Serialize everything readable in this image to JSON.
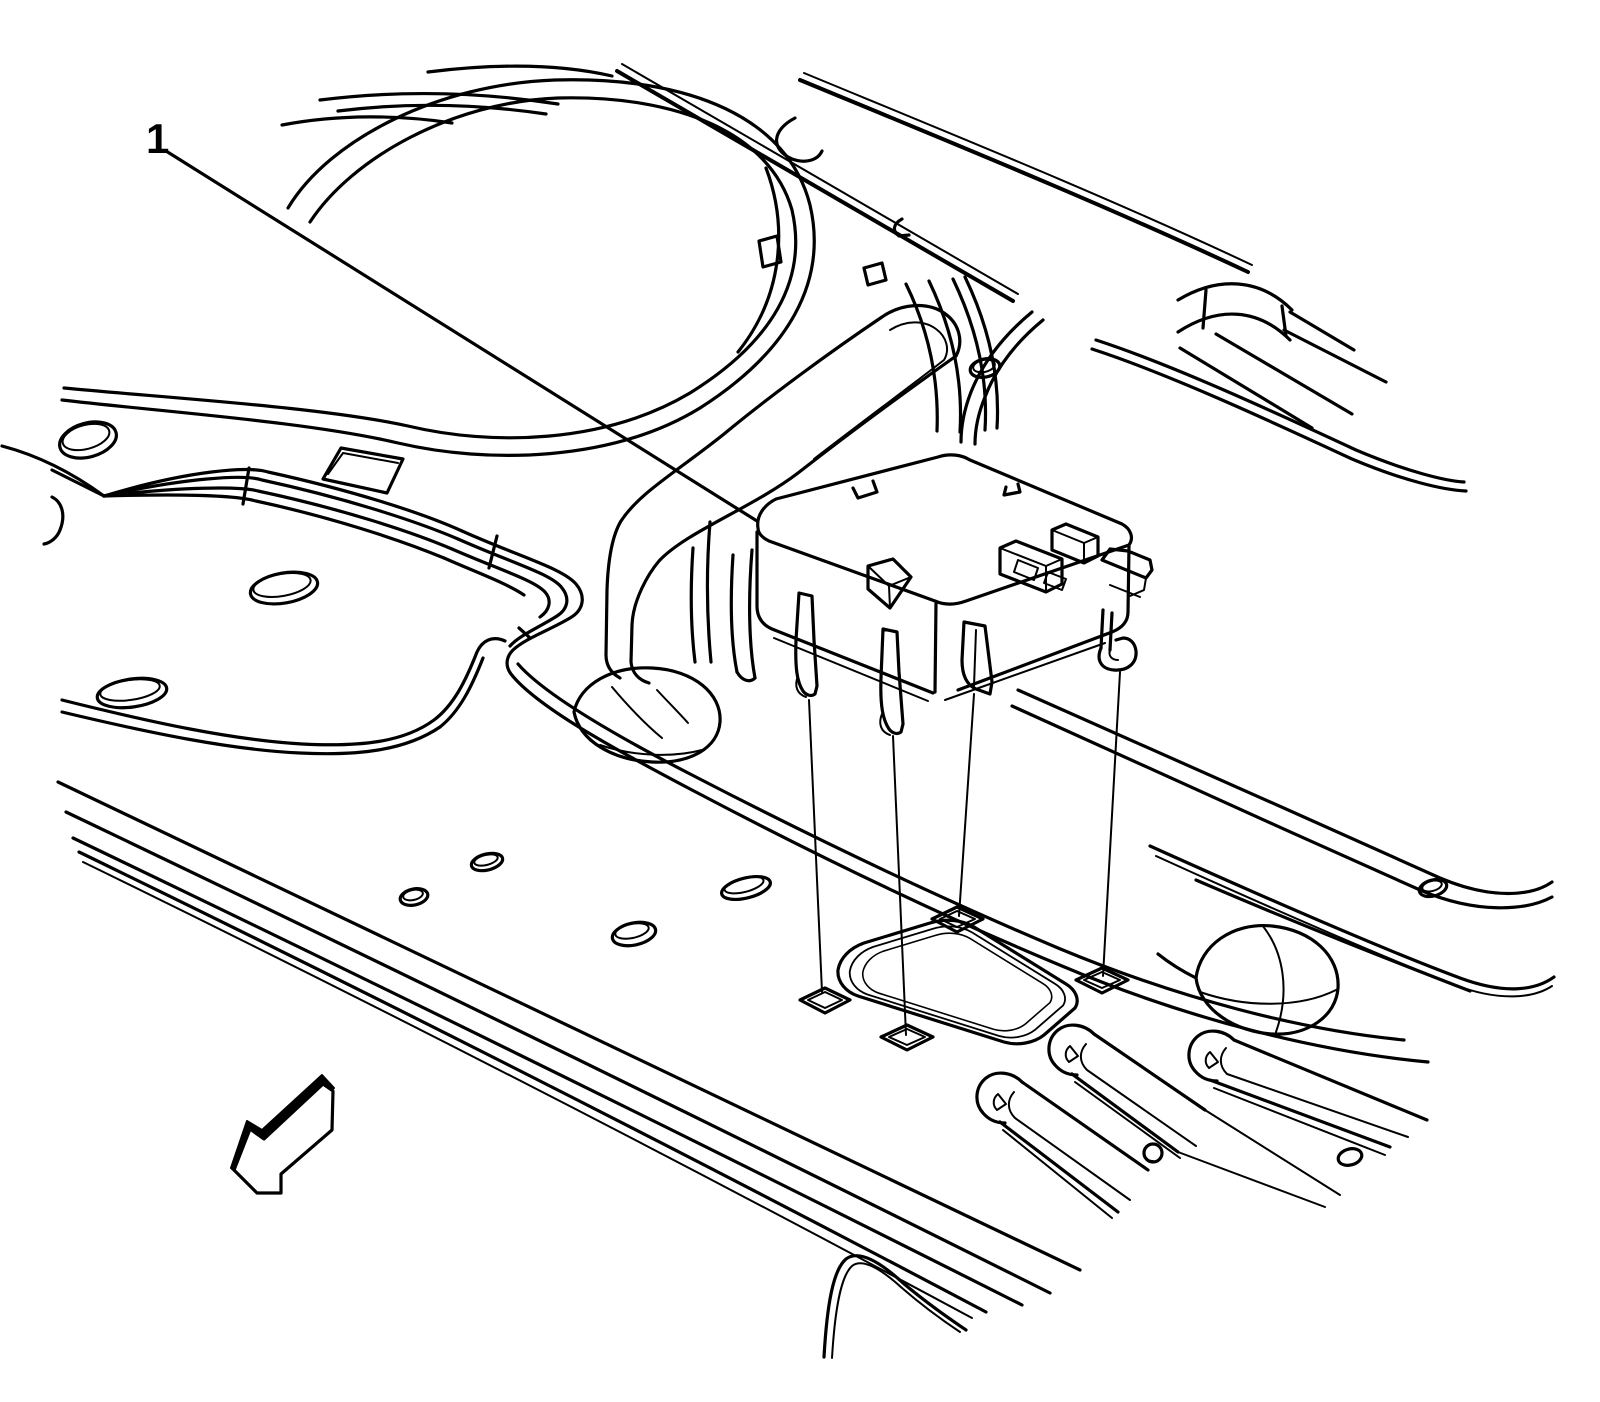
{
  "figure": {
    "type": "technical line illustration",
    "background_color": "#ffffff",
    "line_color": "#000000",
    "callout": {
      "label": "1"
    },
    "icons": [
      {
        "name": "front-direction-arrow",
        "shape": "3d block arrow pointing lower-left",
        "color": "#000000"
      }
    ]
  }
}
